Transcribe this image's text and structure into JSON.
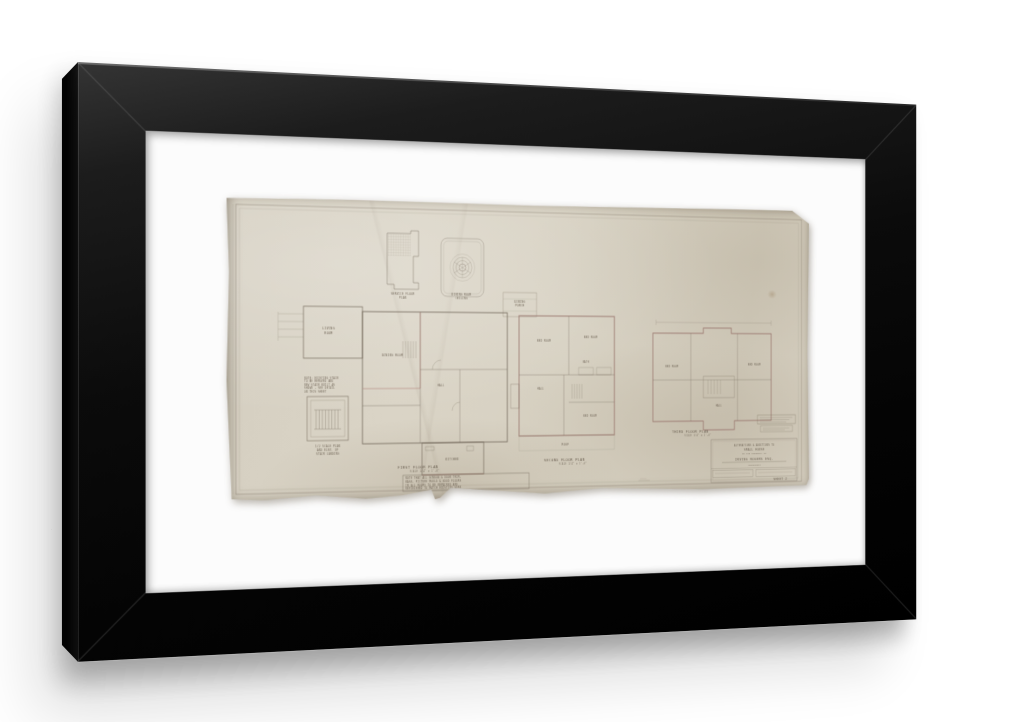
{
  "scene": {
    "background": "#ffffff",
    "frame_color": "#0d0d0d",
    "mat_color": "#fcfcfc",
    "paper_color": "#d8d2c4",
    "description": "Black modern wood frame with white mat holding an aged architectural floor-plan drawing"
  },
  "drawing": {
    "titles": {
      "first_floor": "FIRST FLOOR PLAN",
      "second_floor": "SECOND FLOOR PLAN",
      "third_floor": "THIRD FLOOR PLAN",
      "scale_note": "SCALE 1/4\" = 1'-0\""
    },
    "details": {
      "service_floor_line1": "SERVICE FLOOR",
      "service_floor_line2": "PLAN",
      "ceiling_line1": "DINING ROOM",
      "ceiling_line2": "CEILING",
      "dining_porch_line1": "DINING",
      "dining_porch_line2": "PORCH",
      "stair_detail_line1": "1/2 SCALE PLAN",
      "stair_detail_line2": "AND ELEV. OF",
      "stair_detail_line3": "STAIR LANDING"
    },
    "rooms": {
      "living_1": "LIVING",
      "living_2": "ROOM",
      "dining_room": "DINING ROOM",
      "kitchen": "KITCHEN",
      "hall": "HALL",
      "bath": "BATH",
      "bed_room": "BED ROOM",
      "roof": "ROOF"
    },
    "stair_note": {
      "l1": "NOTE: EXISTING STAIR",
      "l2": "TO BE REMOVED AND",
      "l3": "NEW STAIR BUILT AS",
      "l4": "SHOWN - SEE DETAIL",
      "l5": "ON THIS SHEET"
    },
    "notes_box": {
      "line1": "NOTE THAT ALL WINDOW & DOOR TRIM,",
      "line2": "BASE, PICTURE MOULD & WOOD FLOORS",
      "line3": "IN ALL ROOMS TO BE REPAIRED AND",
      "line4": "REFINISHED TO MATCH EXISTING WORK"
    },
    "title_block": {
      "line1": "ALTERATIONS & ADDITIONS TO",
      "line2": "SMALL HOUSE",
      "line3": "ON THE PROPERTY OF",
      "line4": "IRVING ROGERS ESQ.",
      "line5": "ARCHITECT",
      "sheet": "SHEET 2"
    }
  }
}
